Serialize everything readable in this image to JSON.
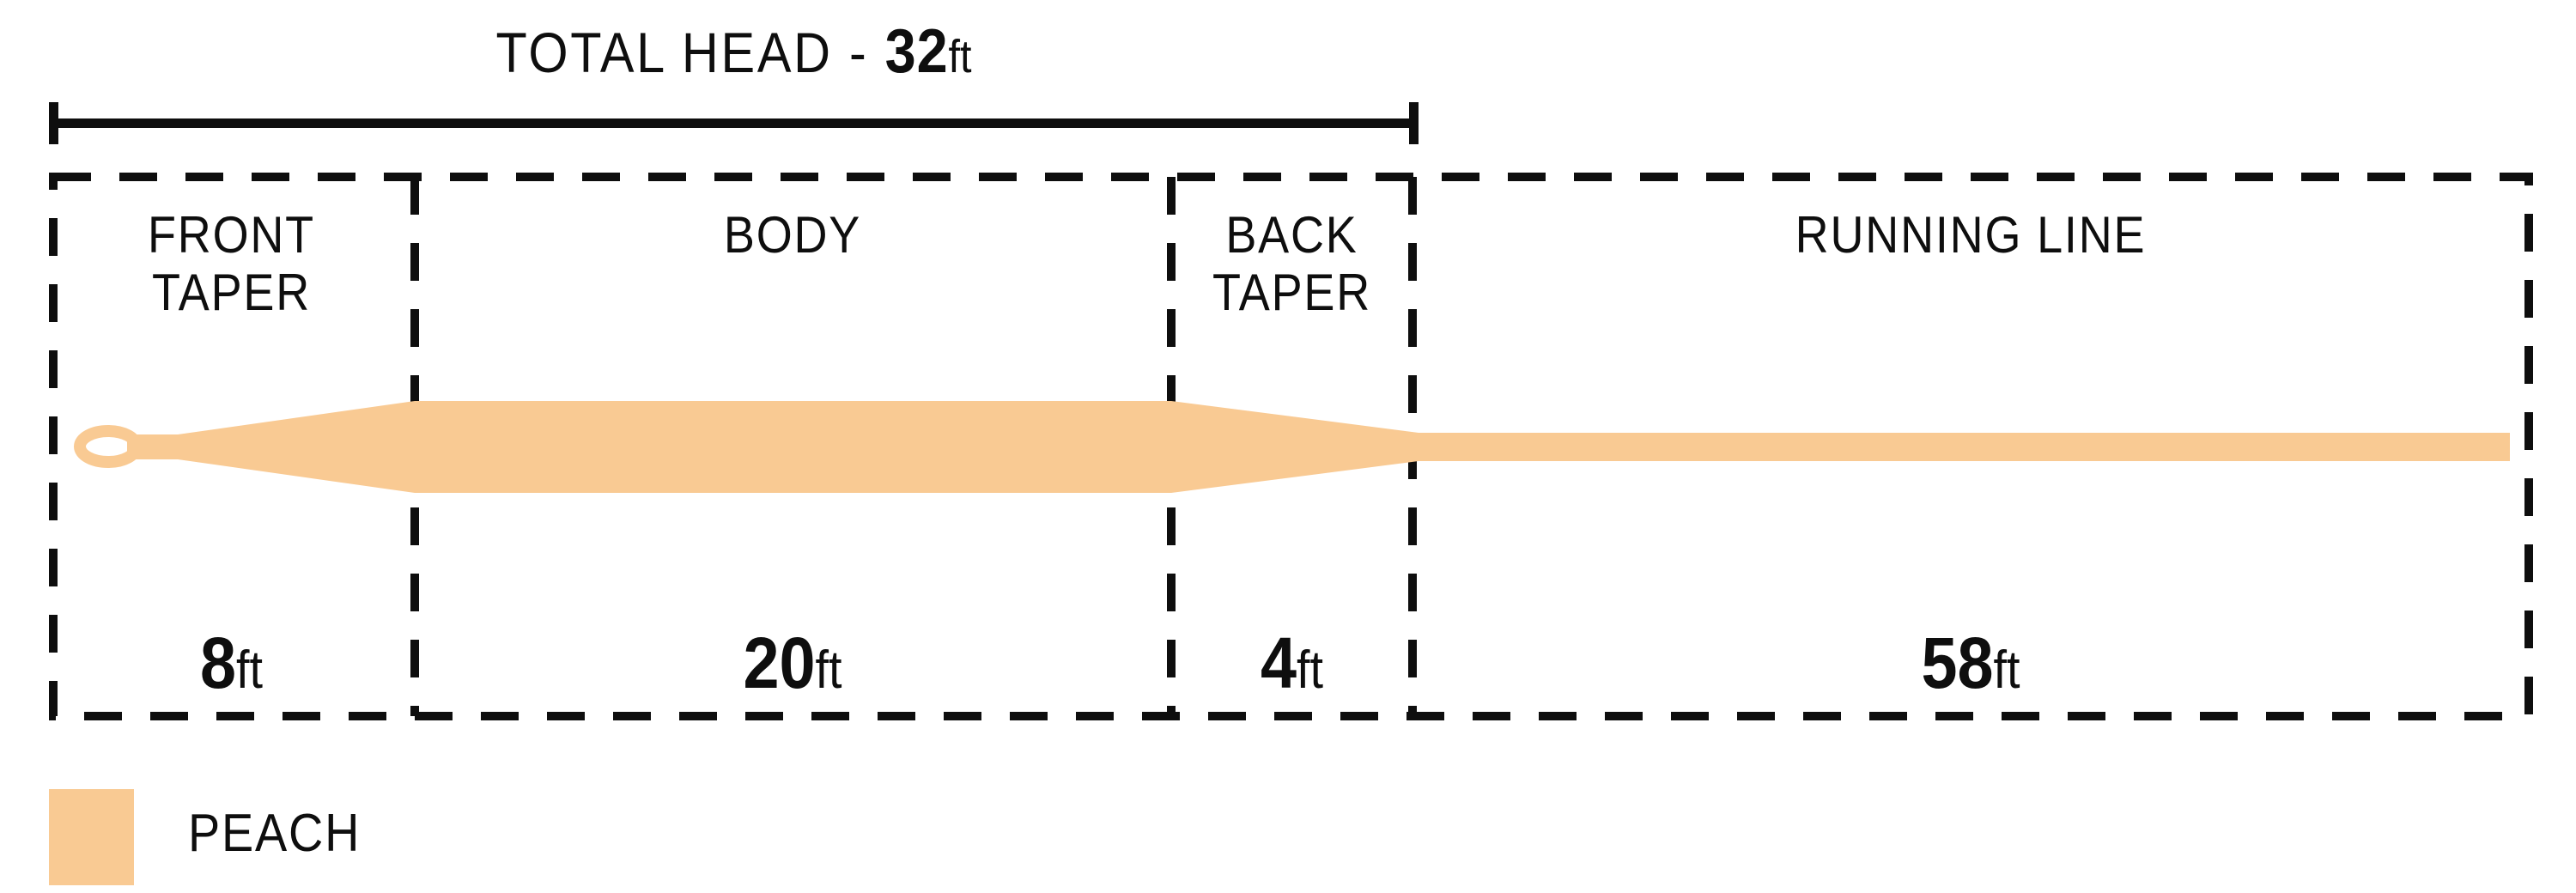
{
  "diagram": {
    "title": {
      "label": "TOTAL HEAD - ",
      "value": "32",
      "unit": "ft"
    },
    "sections": [
      {
        "name": "front-taper",
        "line1": "FRONT",
        "line2": "TAPER",
        "length": "8",
        "unit": "ft"
      },
      {
        "name": "body",
        "line1": "BODY",
        "line2": "",
        "length": "20",
        "unit": "ft"
      },
      {
        "name": "back-taper",
        "line1": "BACK",
        "line2": "TAPER",
        "length": "4",
        "unit": "ft"
      },
      {
        "name": "running-line",
        "line1": "RUNNING LINE",
        "line2": "",
        "length": "58",
        "unit": "ft"
      }
    ],
    "legend": {
      "label": "PEACH"
    },
    "colors": {
      "line": "#F9CA93",
      "ink": "#0E0E0E"
    }
  }
}
